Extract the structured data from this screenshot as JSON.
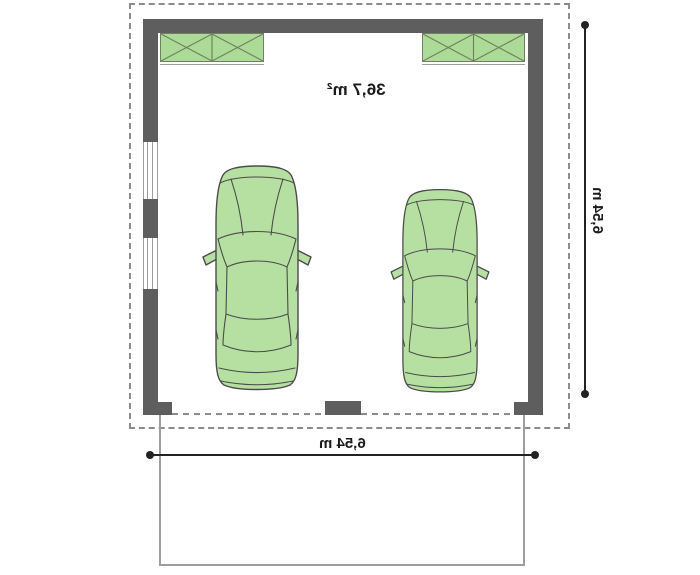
{
  "plan": {
    "area_label": "36,7 m²",
    "dimension_width_label": "6,54 m",
    "dimension_height_label": "6,54 m"
  },
  "icons": {
    "car": "car-top-view",
    "window": "wall-window-symbol",
    "storage_box": "crossed-rectangle-symbol"
  },
  "colors": {
    "wall": "#5e5e5e",
    "hatch_fill": "#abdb97",
    "hatch_stroke": "#708060",
    "car_fill": "#b6e0a2",
    "car_stroke": "#4b4b4b",
    "dashed_line": "#8c8c8c",
    "light_line": "#9e9e9e",
    "dimension_line": "#222222",
    "text": "#1b1b1b",
    "background": "#ffffff"
  }
}
